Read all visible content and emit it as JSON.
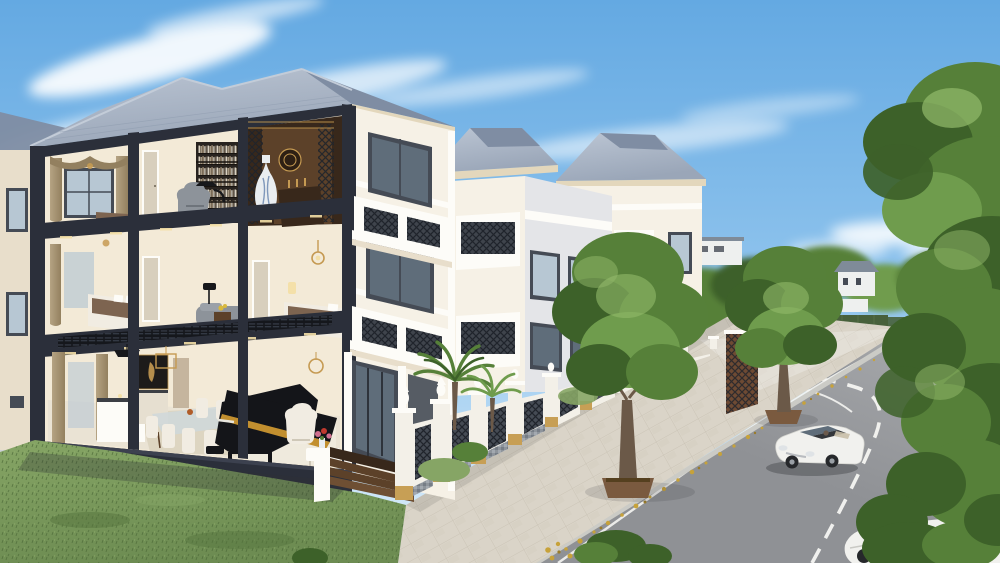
{
  "scene": {
    "description": "3D architectural rendering: luxury three-storey townhouse row with cutaway interior (library and altar room on top floor, bedrooms on middle floor, living room with grand piano on ground floor), white classical facades with iron balconies, ornate white fence, tree-lined street with white convertible car and distant pedestrians under a blue sky",
    "objects": [
      "sky",
      "clouds",
      "bird",
      "distant-park",
      "main-villa-cutaway",
      "library",
      "altar-room",
      "bedrooms",
      "living-room",
      "grand-piano",
      "facade-balconies",
      "fence",
      "palm-trees",
      "street-trees",
      "sidewalk",
      "road",
      "white-car",
      "parked-car",
      "pedestrians",
      "large-right-tree"
    ]
  },
  "palette": {
    "sky_top": "#64a9e2",
    "sky_mid": "#93c6ee",
    "sky_horizon": "#e2f1fb",
    "cloud": "#ffffff",
    "roof_light": "#bcc6d4",
    "roof_slate": "#9aa6b8",
    "roof_dark": "#7f8da3",
    "structure": "#2b2f3a",
    "structure_hi": "#3c414f",
    "fascia_cream": "#e3d7bc",
    "facade_white": "#f6f1e6",
    "facade_shadow": "#e8decb",
    "trim_white": "#fdfcf8",
    "interior_wall": "#f3ead7",
    "interior_warm": "#eee0c6",
    "interior_floor": "#cfb995",
    "marble_floor": "#eae3d4",
    "rug": "#dcd3bf",
    "curtain": "#b5a383",
    "curtain_dark": "#93805f",
    "window_frame": "#454b55",
    "glass_cool": "#b7c7d3",
    "glass_dark": "#5f6d7a",
    "wood": "#5c4129",
    "wood_dark": "#38281b",
    "gold": "#c59a52",
    "bookshelf": "#28231f",
    "sofa_gray": "#8d939a",
    "bed_white": "#f1ece2",
    "bed_brown": "#7d6450",
    "piano": "#141519",
    "piano_gold": "#c28f2f",
    "gray_wall": "#e4e5e8",
    "gray_wall_dark": "#cdd0d6",
    "fence_white": "#f3f0e8",
    "iron": "#363c44",
    "mosaic_a": "#939aa1",
    "sandstone": "#c79f55",
    "lawn": "#6d8c52",
    "lawn_dark": "#55743e",
    "lawn_light": "#86a565",
    "tree_dark": "#3d6129",
    "tree_mid": "#568039",
    "tree_light": "#6f9c4d",
    "tree_hi": "#93ba6b",
    "trunk": "#6b5948",
    "planter": "#7a5a3f",
    "sidewalk": "#dad4c8",
    "sidewalk_line": "#b9b2a2",
    "curb": "#cbcbc6",
    "road": "#8f9195",
    "road_far": "#abadb0",
    "marking": "#f5f5f2",
    "leaf_yellow": "#c7a23a",
    "leaf_dark": "#9a7c2a",
    "car_white": "#f1f1ee",
    "tire": "#26282b",
    "shadow": "#2e3135",
    "ppl_red": "#c0392e",
    "ppl_orange": "#cf7b2e",
    "ppl_blue": "#39659e",
    "ppl_dark": "#41484f",
    "ppl_olive": "#7b7a55",
    "hedge": "#47603b",
    "field": "#7ea45e",
    "flower_pink": "#cf6f8e",
    "distant_white": "#eef0ef",
    "distant_roof": "#7f8b98"
  }
}
